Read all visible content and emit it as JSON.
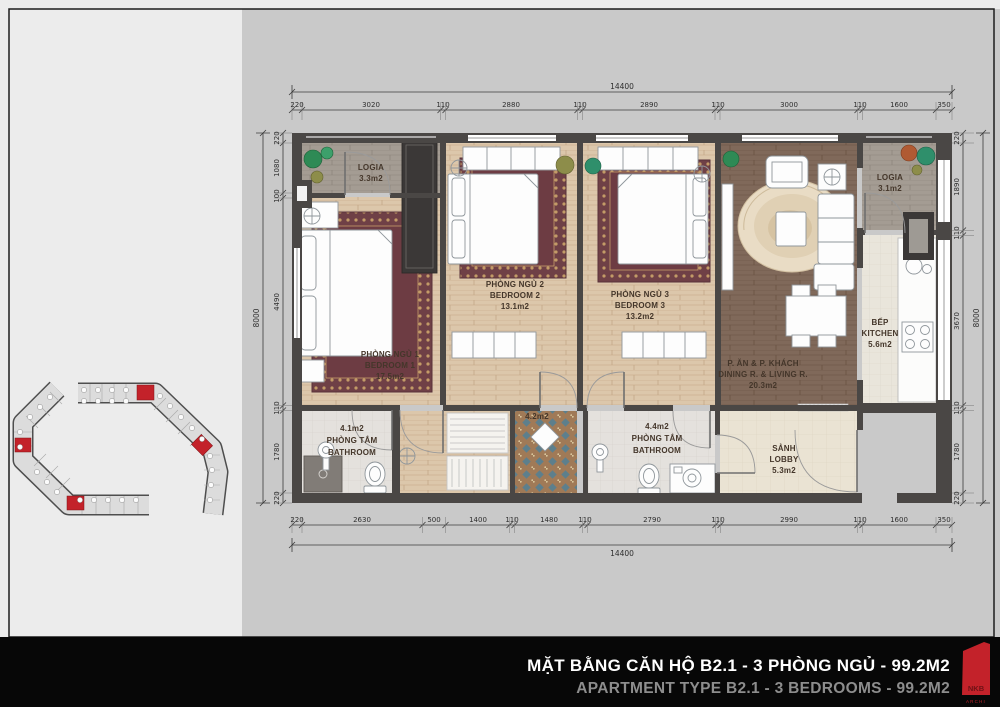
{
  "sheet": {
    "rooms": {
      "logia_left": {
        "name": "LOGIA",
        "area": "3.3m2"
      },
      "bedroom1": {
        "name_vi": "PHÒNG NGỦ 1",
        "name_en": "BEDROOM 1",
        "area": "17.5m2"
      },
      "bedroom2": {
        "name_vi": "PHÒNG NGỦ 2",
        "name_en": "BEDROOM 2",
        "area": "13.1m2"
      },
      "bedroom3": {
        "name_vi": "PHÒNG NGỦ 3",
        "name_en": "BEDROOM 3",
        "area": "13.2m2"
      },
      "living_dining": {
        "name_vi": "P. ĂN & P. KHÁCH",
        "name_en": "DINING R. & LIVING R.",
        "area": "20.3m2"
      },
      "logia_right": {
        "name": "LOGIA",
        "area": "3.1m2"
      },
      "kitchen": {
        "name_vi": "BẾP",
        "name_en": "KITCHEN",
        "area": "5.6m2"
      },
      "bathroom1": {
        "area": "4.1m2",
        "name_vi": "PHÒNG TẮM",
        "name_en": "BATHROOM"
      },
      "hall": {
        "area": "4.2m2"
      },
      "bathroom2": {
        "area": "4.4m2",
        "name_vi": "PHÒNG TẮM",
        "name_en": "BATHROOM"
      },
      "lobby": {
        "name_vi": "SẢNH",
        "name_en": "LOBBY",
        "area": "5.3m2"
      }
    },
    "dims": {
      "top_total": "14400",
      "top": [
        "220",
        "3020",
        "110",
        "2880",
        "110",
        "2890",
        "110",
        "3000",
        "110",
        "1600",
        "350"
      ],
      "bottom": [
        "220",
        "2630",
        "500",
        "1400",
        "110",
        "1480",
        "110",
        "2790",
        "110",
        "2990",
        "110",
        "1600",
        "350"
      ],
      "bottom_total": "14400",
      "left_total": "8000",
      "left": [
        "220",
        "1080",
        "100",
        "4490",
        "110",
        "1780",
        "220"
      ],
      "right": [
        "220",
        "1890",
        "110",
        "3670",
        "110",
        "1780",
        "220"
      ],
      "right_total": "8000"
    },
    "footer": {
      "title_vi": "MẶT BẰNG CĂN HỘ B2.1 - 3 PHÒNG NGỦ - 99.2M2",
      "title_en": "APARTMENT TYPE B2.1 - 3 BEDROOMS - 99.2M2",
      "logo_text": "NKB",
      "logo_sub": "ARCHI"
    },
    "colors": {
      "accent_red": "#c3222a",
      "wall": "#4a4745",
      "footer_bg": "#070707"
    }
  }
}
